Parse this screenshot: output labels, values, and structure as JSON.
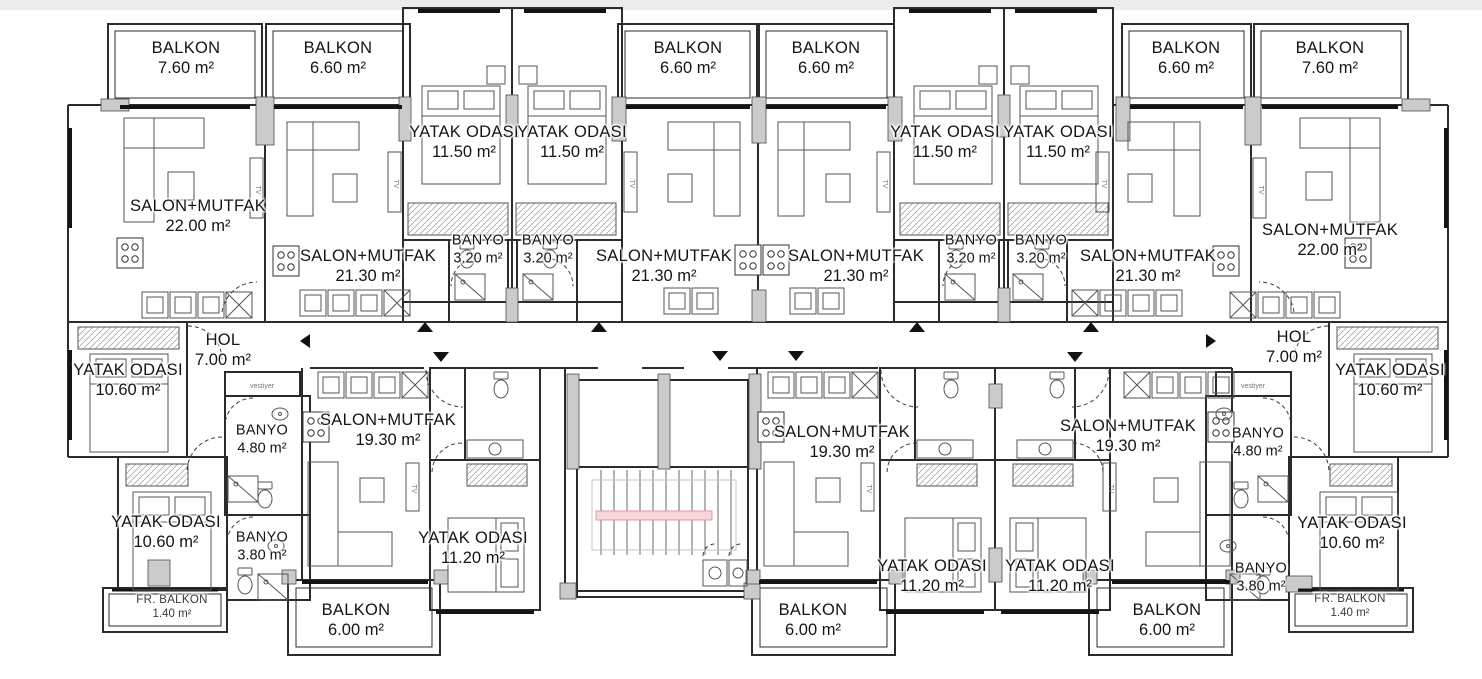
{
  "colors": {
    "wall": "#2b2b2b",
    "background": "#ffffff",
    "top_strip": "#ececec",
    "column_fill": "#cbcbcb",
    "stair_handrail": "#dc9aa1"
  },
  "labels": {
    "tv": "TV",
    "vestiyer": "vestiyer"
  },
  "rooms": [
    {
      "name": "BALKON",
      "area": "7.60 m²"
    },
    {
      "name": "BALKON",
      "area": "6.60 m²"
    },
    {
      "name": "YATAK ODASI",
      "area": "11.50 m²"
    },
    {
      "name": "YATAK ODASI",
      "area": "11.50 m²"
    },
    {
      "name": "BALKON",
      "area": "6.60 m²"
    },
    {
      "name": "BALKON",
      "area": "6.60 m²"
    },
    {
      "name": "YATAK ODASI",
      "area": "11.50 m²"
    },
    {
      "name": "YATAK ODASI",
      "area": "11.50 m²"
    },
    {
      "name": "BALKON",
      "area": "6.60 m²"
    },
    {
      "name": "BALKON",
      "area": "7.60 m²"
    },
    {
      "name": "SALON+MUTFAK",
      "area": "22.00 m²"
    },
    {
      "name": "SALON+MUTFAK",
      "area": "21.30 m²"
    },
    {
      "name": "BANYO",
      "area": "3.20 m²"
    },
    {
      "name": "BANYO",
      "area": "3.20 m²"
    },
    {
      "name": "SALON+MUTFAK",
      "area": "21.30 m²"
    },
    {
      "name": "SALON+MUTFAK",
      "area": "21.30 m²"
    },
    {
      "name": "BANYO",
      "area": "3.20 m²"
    },
    {
      "name": "BANYO",
      "area": "3.20 m²"
    },
    {
      "name": "SALON+MUTFAK",
      "area": "21.30 m²"
    },
    {
      "name": "SALON+MUTFAK",
      "area": "22.00 m²"
    },
    {
      "name": "YATAK ODASI",
      "area": "10.60 m²"
    },
    {
      "name": "HOL",
      "area": "7.00 m²"
    },
    {
      "name": "BANYO",
      "area": "4.80 m²"
    },
    {
      "name": "YATAK ODASI",
      "area": "10.60 m²"
    },
    {
      "name": "BANYO",
      "area": "3.80 m²"
    },
    {
      "name": "FR. BALKON",
      "area": "1.40 m²"
    },
    {
      "name": "SALON+MUTFAK",
      "area": "19.30 m²"
    },
    {
      "name": "YATAK ODASI",
      "area": "11.20 m²"
    },
    {
      "name": "BALKON",
      "area": "6.00 m²"
    },
    {
      "name": "SALON+MUTFAK",
      "area": "19.30 m²"
    },
    {
      "name": "YATAK ODASI",
      "area": "11.20 m²"
    },
    {
      "name": "YATAK ODASI",
      "area": "11.20 m²"
    },
    {
      "name": "BALKON",
      "area": "6.00 m²"
    },
    {
      "name": "SALON+MUTFAK",
      "area": "19.30 m²"
    },
    {
      "name": "BALKON",
      "area": "6.00 m²"
    },
    {
      "name": "HOL",
      "area": "7.00 m²"
    },
    {
      "name": "YATAK ODASI",
      "area": "10.60 m²"
    },
    {
      "name": "BANYO",
      "area": "4.80 m²"
    },
    {
      "name": "YATAK ODASI",
      "area": "10.60 m²"
    },
    {
      "name": "BANYO",
      "area": "3.80 m²"
    },
    {
      "name": "FR. BALKON",
      "area": "1.40 m²"
    }
  ]
}
